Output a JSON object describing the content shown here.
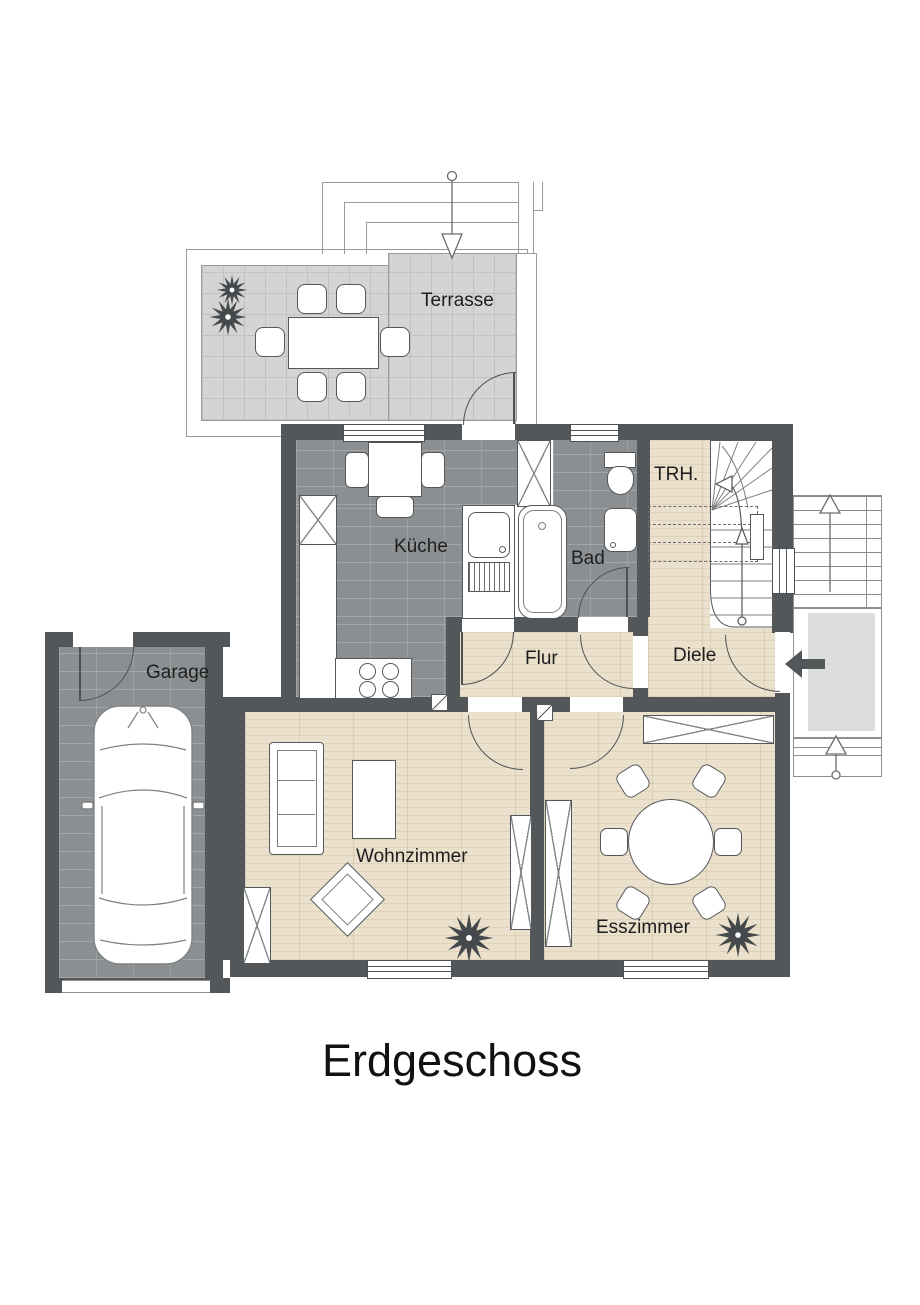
{
  "floor_plan": {
    "title": "Erdgeschoss",
    "rooms": {
      "terrasse": "Terrasse",
      "kueche": "Küche",
      "bad": "Bad",
      "trh": "TRH.",
      "diele": "Diele",
      "flur": "Flur",
      "garage": "Garage",
      "wohnzimmer": "Wohnzimmer",
      "esszimmer": "Esszimmer"
    },
    "colors": {
      "wall": "#54575a",
      "hard_floor": "#8c8f91",
      "wood_floor": "#eae0cb",
      "terrace_tile": "#d4d4d4",
      "stair_landing": "#dcdddd"
    }
  }
}
